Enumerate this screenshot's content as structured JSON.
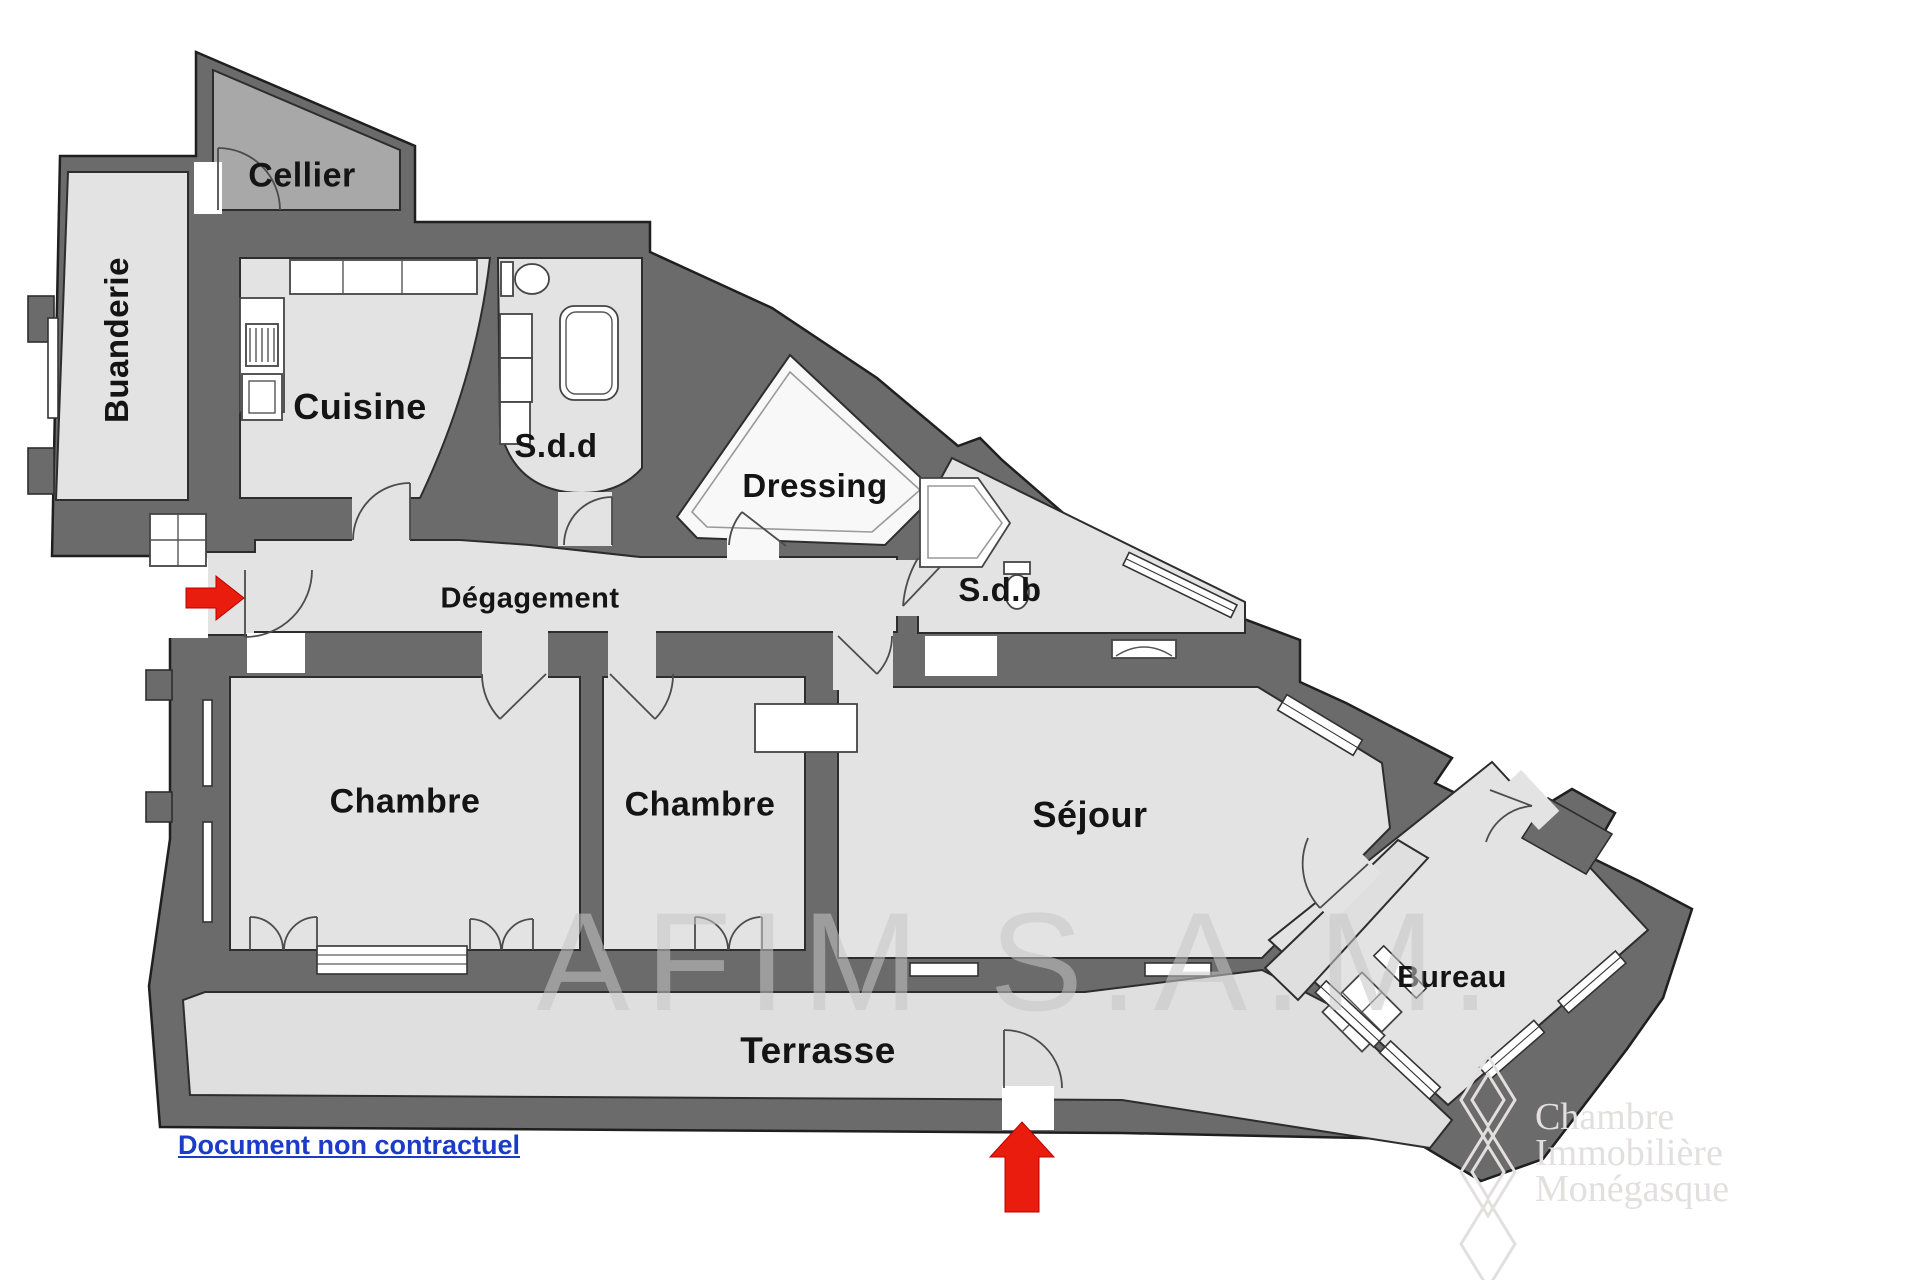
{
  "plan": {
    "rooms": [
      {
        "id": "cellier",
        "label": "Cellier"
      },
      {
        "id": "buanderie",
        "label": "Buanderie"
      },
      {
        "id": "cuisine",
        "label": "Cuisine"
      },
      {
        "id": "salle-de-douche",
        "label": "S.d.d"
      },
      {
        "id": "dressing",
        "label": "Dressing"
      },
      {
        "id": "degagement",
        "label": "Dégagement"
      },
      {
        "id": "salle-de-bain",
        "label": "S.d.b"
      },
      {
        "id": "chambre-1",
        "label": "Chambre"
      },
      {
        "id": "chambre-2",
        "label": "Chambre"
      },
      {
        "id": "sejour",
        "label": "Séjour"
      },
      {
        "id": "bureau",
        "label": "Bureau"
      },
      {
        "id": "terrasse",
        "label": "Terrasse"
      }
    ],
    "watermark": "AFIM S.A.M.",
    "footer_link": "Document non contractuel",
    "logo": {
      "line1": "Chambre",
      "line2": "Immobilière",
      "line3": "Monégasque"
    },
    "arrows": [
      {
        "id": "entrance-arrow",
        "direction": "right"
      },
      {
        "id": "terrace-arrow",
        "direction": "up"
      }
    ],
    "colors": {
      "wall": "#6b6b6b",
      "wall_outline": "#1f1f1f",
      "room": "#e3e3e3",
      "terrace": "#dfdfdf",
      "cellier": "#a8a8a8",
      "dressing": "#f8f8f8",
      "arrow": "#ea1c0d",
      "link": "#1a3cc8",
      "label": "#141414",
      "watermark": "#c6c6c6",
      "logo_text": "#e2dfdf"
    }
  }
}
